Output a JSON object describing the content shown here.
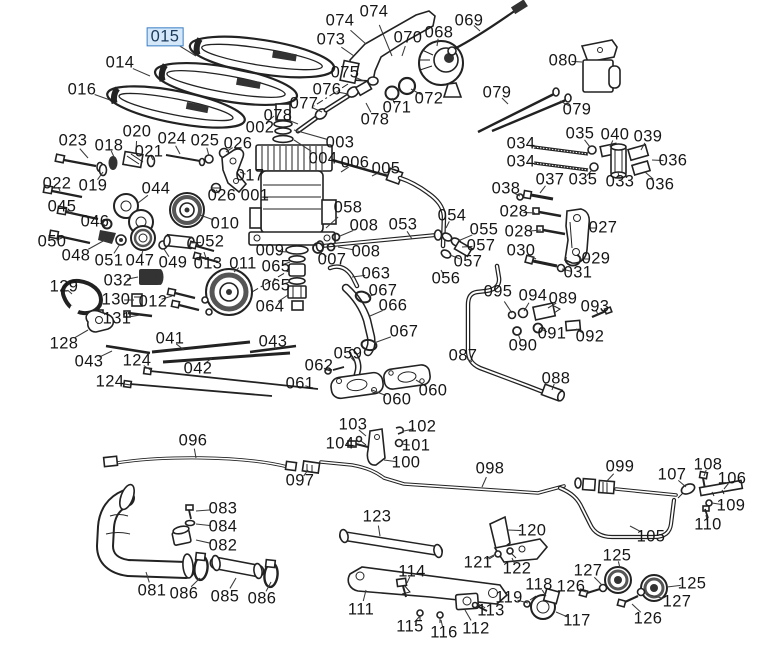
{
  "diagram": {
    "type": "exploded-parts-diagram",
    "selected_part": "015",
    "colors": {
      "background": "#ffffff",
      "line": "#222222",
      "label_text": "#161616",
      "highlight_fill": "#d5e8f9",
      "highlight_border": "#3c7fc4",
      "highlight_text": "#1b3a5c"
    }
  },
  "labels": [
    {
      "t": "015",
      "x": 165,
      "y": 37,
      "lx": 196,
      "ly": 56,
      "hl": true
    },
    {
      "t": "014",
      "x": 120,
      "y": 63,
      "lx": 150,
      "ly": 76
    },
    {
      "t": "016",
      "x": 82,
      "y": 90,
      "lx": 110,
      "ly": 100
    },
    {
      "t": "074",
      "x": 340,
      "y": 21,
      "lx": 366,
      "ly": 44
    },
    {
      "t": "074",
      "x": 374,
      "y": 12,
      "lx": 392,
      "ly": 56
    },
    {
      "t": "073",
      "x": 331,
      "y": 40,
      "lx": 354,
      "ly": 56
    },
    {
      "t": "070",
      "x": 408,
      "y": 38,
      "lx": 402,
      "ly": 56
    },
    {
      "t": "068",
      "x": 439,
      "y": 33,
      "lx": 437,
      "ly": 46
    },
    {
      "t": "069",
      "x": 469,
      "y": 21,
      "lx": 480,
      "ly": 31
    },
    {
      "t": "075",
      "x": 345,
      "y": 73,
      "lx": 364,
      "ly": 81
    },
    {
      "t": "076",
      "x": 327,
      "y": 90,
      "lx": 348,
      "ly": 94
    },
    {
      "t": "077",
      "x": 304,
      "y": 104,
      "lx": 322,
      "ly": 112
    },
    {
      "t": "078",
      "x": 278,
      "y": 116,
      "lx": 298,
      "ly": 124
    },
    {
      "t": "078",
      "x": 375,
      "y": 120,
      "lx": 366,
      "ly": 103
    },
    {
      "t": "071",
      "x": 397,
      "y": 108,
      "lx": 392,
      "ly": 98
    },
    {
      "t": "072",
      "x": 429,
      "y": 99,
      "lx": 411,
      "ly": 89
    },
    {
      "t": "079",
      "x": 497,
      "y": 93,
      "lx": 508,
      "ly": 104
    },
    {
      "t": "080",
      "x": 563,
      "y": 61,
      "lx": 582,
      "ly": 62
    },
    {
      "t": "079",
      "x": 577,
      "y": 110,
      "lx": 560,
      "ly": 101
    },
    {
      "t": "034",
      "x": 521,
      "y": 144,
      "lx": 537,
      "ly": 147
    },
    {
      "t": "034",
      "x": 521,
      "y": 162,
      "lx": 537,
      "ly": 164
    },
    {
      "t": "035",
      "x": 580,
      "y": 134,
      "lx": 590,
      "ly": 147
    },
    {
      "t": "040",
      "x": 615,
      "y": 135,
      "lx": 610,
      "ly": 147
    },
    {
      "t": "039",
      "x": 648,
      "y": 137,
      "lx": 641,
      "ly": 150
    },
    {
      "t": "036",
      "x": 673,
      "y": 161,
      "lx": 652,
      "ly": 160
    },
    {
      "t": "037",
      "x": 550,
      "y": 180,
      "lx": 540,
      "ly": 193
    },
    {
      "t": "035",
      "x": 583,
      "y": 180,
      "lx": 592,
      "ly": 170
    },
    {
      "t": "033",
      "x": 620,
      "y": 182,
      "lx": 618,
      "ly": 172
    },
    {
      "t": "036",
      "x": 660,
      "y": 185,
      "lx": 645,
      "ly": 172
    },
    {
      "t": "038",
      "x": 506,
      "y": 189,
      "lx": 520,
      "ly": 196
    },
    {
      "t": "028",
      "x": 514,
      "y": 212,
      "lx": 535,
      "ly": 213
    },
    {
      "t": "028",
      "x": 519,
      "y": 232,
      "lx": 541,
      "ly": 230
    },
    {
      "t": "027",
      "x": 603,
      "y": 228,
      "lx": 588,
      "ly": 228
    },
    {
      "t": "030",
      "x": 521,
      "y": 251,
      "lx": 536,
      "ly": 259
    },
    {
      "t": "029",
      "x": 596,
      "y": 259,
      "lx": 580,
      "ly": 259
    },
    {
      "t": "031",
      "x": 578,
      "y": 273,
      "lx": 562,
      "ly": 269
    },
    {
      "t": "023",
      "x": 73,
      "y": 141,
      "lx": 88,
      "ly": 158
    },
    {
      "t": "018",
      "x": 109,
      "y": 146,
      "lx": 114,
      "ly": 157
    },
    {
      "t": "020",
      "x": 137,
      "y": 132,
      "lx": 136,
      "ly": 152
    },
    {
      "t": "024",
      "x": 172,
      "y": 139,
      "lx": 180,
      "ly": 154
    },
    {
      "t": "025",
      "x": 205,
      "y": 141,
      "lx": 209,
      "ly": 156
    },
    {
      "t": "026",
      "x": 238,
      "y": 144,
      "lx": 226,
      "ly": 152
    },
    {
      "t": "021",
      "x": 149,
      "y": 152,
      "lx": 153,
      "ly": 160
    },
    {
      "t": "022",
      "x": 57,
      "y": 184,
      "lx": 60,
      "ly": 191
    },
    {
      "t": "019",
      "x": 93,
      "y": 186,
      "lx": 103,
      "ly": 172
    },
    {
      "t": "044",
      "x": 156,
      "y": 189,
      "lx": 138,
      "ly": 203
    },
    {
      "t": "017",
      "x": 250,
      "y": 176,
      "lx": 240,
      "ly": 172
    },
    {
      "t": "002",
      "x": 260,
      "y": 128,
      "lx": 274,
      "ly": 116
    },
    {
      "t": "003",
      "x": 340,
      "y": 143,
      "lx": 294,
      "ly": 130
    },
    {
      "t": "004",
      "x": 323,
      "y": 159,
      "lx": 294,
      "ly": 140
    },
    {
      "t": "006",
      "x": 355,
      "y": 163,
      "lx": 341,
      "ly": 172
    },
    {
      "t": "005",
      "x": 386,
      "y": 169,
      "lx": 372,
      "ly": 176
    },
    {
      "t": "026",
      "x": 222,
      "y": 196,
      "lx": 216,
      "ly": 190
    },
    {
      "t": "001",
      "x": 255,
      "y": 196,
      "lx": 268,
      "ly": 198
    },
    {
      "t": "045",
      "x": 62,
      "y": 207,
      "lx": 72,
      "ly": 214
    },
    {
      "t": "046",
      "x": 95,
      "y": 222,
      "lx": 105,
      "ly": 225
    },
    {
      "t": "050",
      "x": 52,
      "y": 242,
      "lx": 62,
      "ly": 238
    },
    {
      "t": "010",
      "x": 225,
      "y": 224,
      "lx": 200,
      "ly": 215
    },
    {
      "t": "052",
      "x": 210,
      "y": 242,
      "lx": 190,
      "ly": 243
    },
    {
      "t": "048",
      "x": 76,
      "y": 256,
      "lx": 105,
      "ly": 240
    },
    {
      "t": "051",
      "x": 109,
      "y": 261,
      "lx": 120,
      "ly": 244
    },
    {
      "t": "047",
      "x": 140,
      "y": 261,
      "lx": 143,
      "ly": 250
    },
    {
      "t": "049",
      "x": 173,
      "y": 263,
      "lx": 164,
      "ly": 249
    },
    {
      "t": "013",
      "x": 208,
      "y": 264,
      "lx": 204,
      "ly": 252
    },
    {
      "t": "011",
      "x": 243,
      "y": 264,
      "lx": 234,
      "ly": 272
    },
    {
      "t": "032",
      "x": 118,
      "y": 281,
      "lx": 138,
      "ly": 277
    },
    {
      "t": "129",
      "x": 64,
      "y": 287,
      "lx": 72,
      "ly": 294
    },
    {
      "t": "130",
      "x": 116,
      "y": 300,
      "lx": 134,
      "ly": 300
    },
    {
      "t": "012",
      "x": 153,
      "y": 302,
      "lx": 172,
      "ly": 296
    },
    {
      "t": "131",
      "x": 117,
      "y": 319,
      "lx": 140,
      "ly": 315
    },
    {
      "t": "128",
      "x": 64,
      "y": 344,
      "lx": 88,
      "ly": 330
    },
    {
      "t": "041",
      "x": 170,
      "y": 339,
      "lx": 184,
      "ly": 350
    },
    {
      "t": "043",
      "x": 89,
      "y": 362,
      "lx": 112,
      "ly": 351
    },
    {
      "t": "124",
      "x": 137,
      "y": 361,
      "lx": 152,
      "ly": 371
    },
    {
      "t": "042",
      "x": 198,
      "y": 369,
      "lx": 212,
      "ly": 358
    },
    {
      "t": "124",
      "x": 110,
      "y": 382,
      "lx": 131,
      "ly": 385
    },
    {
      "t": "043",
      "x": 273,
      "y": 342,
      "lx": 276,
      "ly": 350
    },
    {
      "t": "058",
      "x": 348,
      "y": 208,
      "lx": 326,
      "ly": 228
    },
    {
      "t": "008",
      "x": 364,
      "y": 226,
      "lx": 340,
      "ly": 236
    },
    {
      "t": "053",
      "x": 403,
      "y": 225,
      "lx": 412,
      "ly": 239
    },
    {
      "t": "008",
      "x": 366,
      "y": 252,
      "lx": 338,
      "ly": 247
    },
    {
      "t": "009",
      "x": 270,
      "y": 251,
      "lx": 288,
      "ly": 252
    },
    {
      "t": "007",
      "x": 332,
      "y": 260,
      "lx": 320,
      "ly": 252
    },
    {
      "t": "065",
      "x": 276,
      "y": 267,
      "lx": 290,
      "ly": 262
    },
    {
      "t": "065",
      "x": 276,
      "y": 286,
      "lx": 290,
      "ly": 282
    },
    {
      "t": "064",
      "x": 270,
      "y": 307,
      "lx": 288,
      "ly": 295
    },
    {
      "t": "063",
      "x": 376,
      "y": 274,
      "lx": 352,
      "ly": 277
    },
    {
      "t": "067",
      "x": 383,
      "y": 291,
      "lx": 368,
      "ly": 297
    },
    {
      "t": "066",
      "x": 393,
      "y": 306,
      "lx": 370,
      "ly": 316
    },
    {
      "t": "067",
      "x": 404,
      "y": 332,
      "lx": 374,
      "ly": 343
    },
    {
      "t": "054",
      "x": 452,
      "y": 216,
      "lx": 446,
      "ly": 228
    },
    {
      "t": "055",
      "x": 484,
      "y": 230,
      "lx": 458,
      "ly": 241
    },
    {
      "t": "057",
      "x": 481,
      "y": 246,
      "lx": 462,
      "ly": 247
    },
    {
      "t": "057",
      "x": 468,
      "y": 262,
      "lx": 450,
      "ly": 255
    },
    {
      "t": "056",
      "x": 446,
      "y": 279,
      "lx": 441,
      "ly": 270
    },
    {
      "t": "095",
      "x": 498,
      "y": 292,
      "lx": 512,
      "ly": 313
    },
    {
      "t": "094",
      "x": 533,
      "y": 296,
      "lx": 524,
      "ly": 311
    },
    {
      "t": "089",
      "x": 563,
      "y": 299,
      "lx": 548,
      "ly": 308
    },
    {
      "t": "093",
      "x": 595,
      "y": 307,
      "lx": 598,
      "ly": 315
    },
    {
      "t": "091",
      "x": 552,
      "y": 334,
      "lx": 541,
      "ly": 329
    },
    {
      "t": "092",
      "x": 590,
      "y": 337,
      "lx": 576,
      "ly": 329
    },
    {
      "t": "090",
      "x": 523,
      "y": 346,
      "lx": 518,
      "ly": 334
    },
    {
      "t": "087",
      "x": 463,
      "y": 356,
      "lx": 472,
      "ly": 362
    },
    {
      "t": "088",
      "x": 556,
      "y": 379,
      "lx": 552,
      "ly": 390
    },
    {
      "t": "059",
      "x": 348,
      "y": 354,
      "lx": 355,
      "ly": 362
    },
    {
      "t": "062",
      "x": 319,
      "y": 366,
      "lx": 330,
      "ly": 371
    },
    {
      "t": "061",
      "x": 300,
      "y": 384,
      "lx": 312,
      "ly": 388
    },
    {
      "t": "060",
      "x": 397,
      "y": 400,
      "lx": 372,
      "ly": 390
    },
    {
      "t": "060",
      "x": 433,
      "y": 391,
      "lx": 416,
      "ly": 380
    },
    {
      "t": "096",
      "x": 193,
      "y": 441,
      "lx": 196,
      "ly": 458
    },
    {
      "t": "097",
      "x": 300,
      "y": 481,
      "lx": 308,
      "ly": 470
    },
    {
      "t": "083",
      "x": 223,
      "y": 509,
      "lx": 196,
      "ly": 511
    },
    {
      "t": "084",
      "x": 223,
      "y": 527,
      "lx": 196,
      "ly": 524
    },
    {
      "t": "082",
      "x": 223,
      "y": 546,
      "lx": 196,
      "ly": 540
    },
    {
      "t": "081",
      "x": 152,
      "y": 591,
      "lx": 146,
      "ly": 572
    },
    {
      "t": "086",
      "x": 184,
      "y": 594,
      "lx": 200,
      "ly": 578
    },
    {
      "t": "085",
      "x": 225,
      "y": 597,
      "lx": 236,
      "ly": 578
    },
    {
      "t": "086",
      "x": 262,
      "y": 599,
      "lx": 271,
      "ly": 582
    },
    {
      "t": "103",
      "x": 353,
      "y": 425,
      "lx": 366,
      "ly": 436
    },
    {
      "t": "102",
      "x": 422,
      "y": 427,
      "lx": 404,
      "ly": 431
    },
    {
      "t": "104",
      "x": 340,
      "y": 444,
      "lx": 356,
      "ly": 446
    },
    {
      "t": "101",
      "x": 416,
      "y": 446,
      "lx": 402,
      "ly": 444
    },
    {
      "t": "100",
      "x": 406,
      "y": 463,
      "lx": 384,
      "ly": 460
    },
    {
      "t": "098",
      "x": 490,
      "y": 469,
      "lx": 482,
      "ly": 487
    },
    {
      "t": "123",
      "x": 377,
      "y": 517,
      "lx": 380,
      "ly": 536
    },
    {
      "t": "099",
      "x": 620,
      "y": 467,
      "lx": 606,
      "ly": 482
    },
    {
      "t": "107",
      "x": 672,
      "y": 475,
      "lx": 686,
      "ly": 487
    },
    {
      "t": "108",
      "x": 708,
      "y": 465,
      "lx": 704,
      "ly": 476
    },
    {
      "t": "106",
      "x": 732,
      "y": 479,
      "lx": 724,
      "ly": 489
    },
    {
      "t": "109",
      "x": 731,
      "y": 506,
      "lx": 712,
      "ly": 503
    },
    {
      "t": "110",
      "x": 708,
      "y": 525,
      "lx": 706,
      "ly": 515
    },
    {
      "t": "105",
      "x": 651,
      "y": 537,
      "lx": 630,
      "ly": 526
    },
    {
      "t": "114",
      "x": 412,
      "y": 572,
      "lx": 407,
      "ly": 583
    },
    {
      "t": "111",
      "x": 361,
      "y": 610,
      "lx": 366,
      "ly": 590
    },
    {
      "t": "115",
      "x": 410,
      "y": 627,
      "lx": 420,
      "ly": 616
    },
    {
      "t": "116",
      "x": 444,
      "y": 633,
      "lx": 441,
      "ly": 620
    },
    {
      "t": "112",
      "x": 476,
      "y": 629,
      "lx": 465,
      "ly": 610
    },
    {
      "t": "113",
      "x": 491,
      "y": 611,
      "lx": 478,
      "ly": 604
    },
    {
      "t": "121",
      "x": 478,
      "y": 563,
      "lx": 496,
      "ly": 554
    },
    {
      "t": "122",
      "x": 517,
      "y": 569,
      "lx": 512,
      "ly": 558
    },
    {
      "t": "120",
      "x": 532,
      "y": 531,
      "lx": 508,
      "ly": 530
    },
    {
      "t": "118",
      "x": 539,
      "y": 585,
      "lx": 546,
      "ly": 596
    },
    {
      "t": "119",
      "x": 509,
      "y": 598,
      "lx": 528,
      "ly": 603
    },
    {
      "t": "117",
      "x": 577,
      "y": 621,
      "lx": 556,
      "ly": 612
    },
    {
      "t": "125",
      "x": 617,
      "y": 556,
      "lx": 620,
      "ly": 568
    },
    {
      "t": "127",
      "x": 588,
      "y": 571,
      "lx": 602,
      "ly": 585
    },
    {
      "t": "126",
      "x": 571,
      "y": 587,
      "lx": 586,
      "ly": 592
    },
    {
      "t": "125",
      "x": 692,
      "y": 584,
      "lx": 667,
      "ly": 587
    },
    {
      "t": "127",
      "x": 677,
      "y": 602,
      "lx": 646,
      "ly": 594
    },
    {
      "t": "126",
      "x": 648,
      "y": 619,
      "lx": 632,
      "ly": 604
    }
  ]
}
